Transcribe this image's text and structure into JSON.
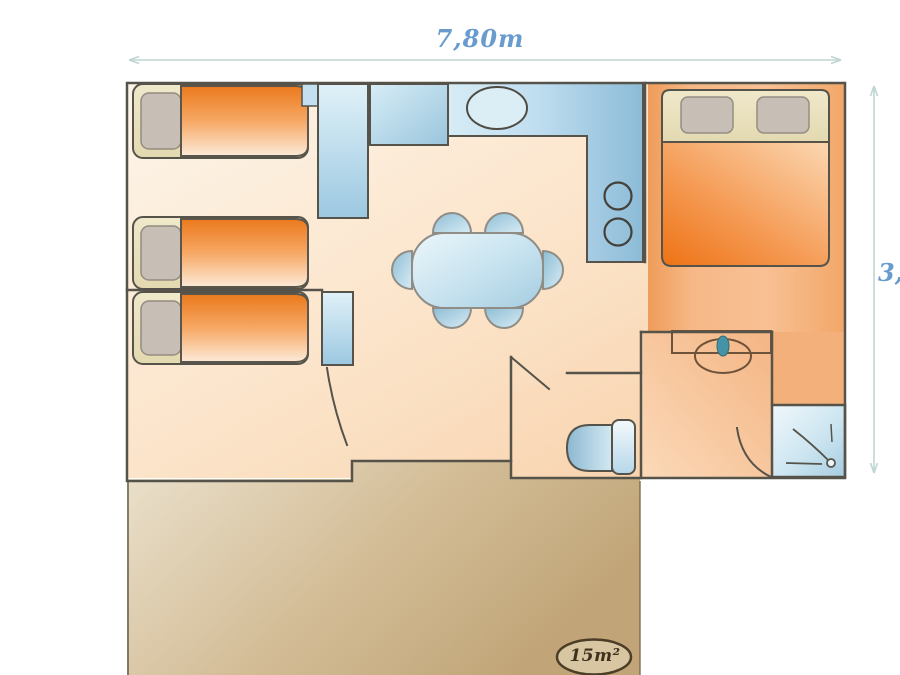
{
  "title_hint": "mobile-home floor plan",
  "dimensions": {
    "width_label": "7,80m",
    "height_label": "3,"
  },
  "terrace": {
    "area_label": "15m²"
  },
  "furniture_icons": [
    "single-bed",
    "single-bed",
    "single-bed",
    "double-bed",
    "wardrobe",
    "shelf",
    "fridge-cabinet",
    "kitchen-counter",
    "kitchen-sink",
    "hob-burner",
    "hob-burner",
    "dining-table",
    "chair",
    "chair",
    "chair",
    "chair",
    "chair",
    "chair",
    "toilet",
    "washbasin",
    "vanity",
    "shower"
  ],
  "colors": {
    "label_blue": "#689bce",
    "dimension_line": "#bfd6d2",
    "wall": "#56534a",
    "floor_light_peach": "#fdf3e7",
    "floor_salmon": "#f3a96f",
    "bed_orange": "#ec7a1d",
    "bed_frame_cream": "#eae1c0",
    "pillow_gray": "#c7bfb5",
    "furniture_blue": "#a9cfe4",
    "terrace_tan": "#cdb38a",
    "area_badge_text": "#3e321d",
    "vanity_brown": "#6f523a"
  }
}
